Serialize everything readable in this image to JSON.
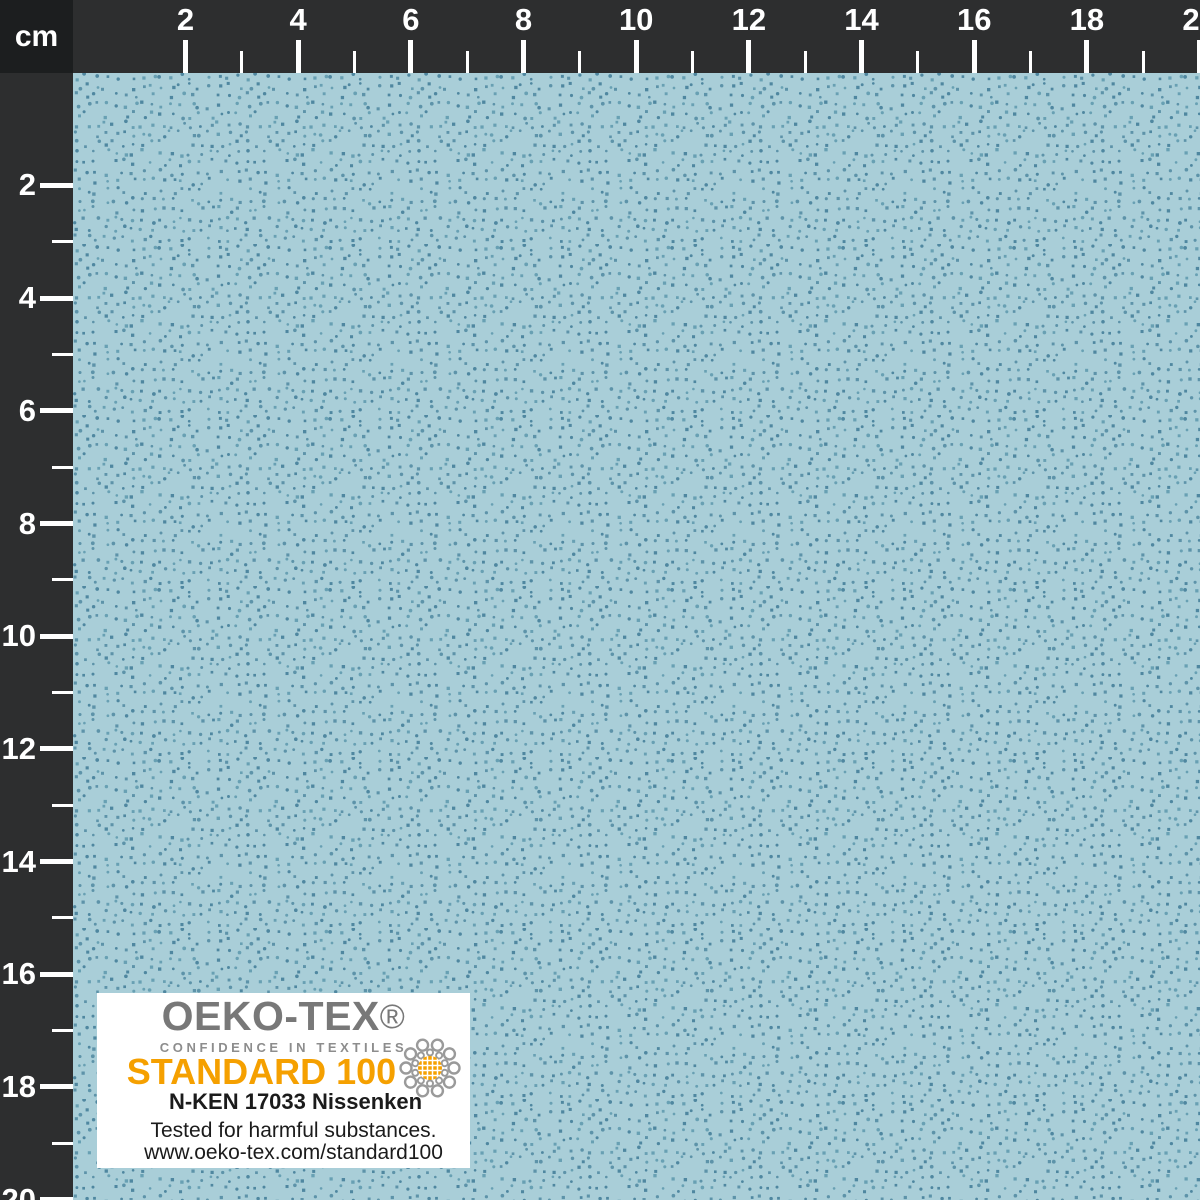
{
  "ruler": {
    "unit": "cm",
    "tick_labels": [
      "2",
      "4",
      "6",
      "8",
      "10",
      "12",
      "14",
      "16",
      "18",
      "20"
    ]
  },
  "fabric": {
    "description": "light blue cotton fabric with small darker blue pin dots",
    "base_color": "#a9ced8",
    "dot_colors": [
      "#4f87a0",
      "#5d93a9",
      "#68a0b3"
    ]
  },
  "colors": {
    "ruler_bg": "#2d2e2f",
    "corner_bg": "#1c1e1f",
    "tick": "#ffffff",
    "accent_orange": "#f5a000",
    "brand_gray": "#787878",
    "icon_gray": "#9a9a9a"
  },
  "certification_label": {
    "brand": "OEKO-TEX",
    "registered_mark": "®",
    "tagline": "CONFIDENCE IN TEXTILES",
    "standard": "STANDARD 100",
    "certificate": "N-KEN 17033 Nissenken",
    "tested_text": "Tested for harmful substances.",
    "website": "www.oeko-tex.com/standard100",
    "icon": "oeko-tex-globe-ornament-icon"
  }
}
